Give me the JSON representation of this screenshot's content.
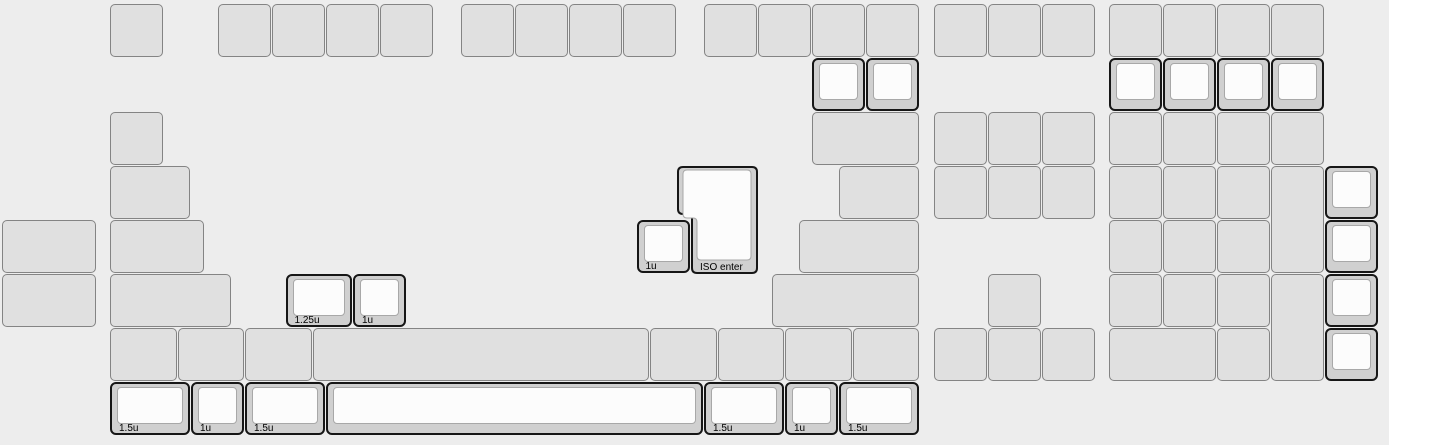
{
  "canvas": {
    "width_px": 1389,
    "height_px": 445,
    "background_color": "#ededed",
    "page_background": "#ffffff"
  },
  "key_style": {
    "unit_px": 54,
    "origin_x_px": 2,
    "origin_y_px": 4,
    "plain_fill": "#e0e0e0",
    "plain_border": "#848484",
    "selected_outer_fill": "#d0d0d0",
    "selected_outline": "#161616",
    "selected_top_fill": "#fcfcfc",
    "selected_top_border": "#a8a8a8",
    "label_color": "#000000"
  },
  "keys": [
    [
      2,
      0,
      1,
      1,
      0,
      ""
    ],
    [
      4,
      0,
      1,
      1,
      0,
      ""
    ],
    [
      5,
      0,
      1,
      1,
      0,
      ""
    ],
    [
      6,
      0,
      1,
      1,
      0,
      ""
    ],
    [
      7,
      0,
      1,
      1,
      0,
      ""
    ],
    [
      8.5,
      0,
      1,
      1,
      0,
      ""
    ],
    [
      9.5,
      0,
      1,
      1,
      0,
      ""
    ],
    [
      10.5,
      0,
      1,
      1,
      0,
      ""
    ],
    [
      11.5,
      0,
      1,
      1,
      0,
      ""
    ],
    [
      13,
      0,
      1,
      1,
      0,
      ""
    ],
    [
      14,
      0,
      1,
      1,
      0,
      ""
    ],
    [
      15,
      0,
      1,
      1,
      0,
      ""
    ],
    [
      16,
      0,
      1,
      1,
      0,
      ""
    ],
    [
      17.25,
      0,
      1,
      1,
      0,
      ""
    ],
    [
      18.25,
      0,
      1,
      1,
      0,
      ""
    ],
    [
      19.25,
      0,
      1,
      1,
      0,
      ""
    ],
    [
      20.5,
      0,
      1,
      1,
      0,
      ""
    ],
    [
      21.5,
      0,
      1,
      1,
      0,
      ""
    ],
    [
      22.5,
      0,
      1,
      1,
      0,
      ""
    ],
    [
      23.5,
      0,
      1,
      1,
      0,
      ""
    ],
    [
      15,
      1,
      1,
      1,
      1,
      ""
    ],
    [
      16,
      1,
      1,
      1,
      1,
      ""
    ],
    [
      20.5,
      1,
      1,
      1,
      1,
      ""
    ],
    [
      21.5,
      1,
      1,
      1,
      1,
      ""
    ],
    [
      22.5,
      1,
      1,
      1,
      1,
      ""
    ],
    [
      23.5,
      1,
      1,
      1,
      1,
      ""
    ],
    [
      2,
      2,
      1,
      1,
      0,
      ""
    ],
    [
      15,
      2,
      2,
      1,
      0,
      ""
    ],
    [
      17.25,
      2,
      1,
      1,
      0,
      ""
    ],
    [
      18.25,
      2,
      1,
      1,
      0,
      ""
    ],
    [
      19.25,
      2,
      1,
      1,
      0,
      ""
    ],
    [
      20.5,
      2,
      1,
      1,
      0,
      ""
    ],
    [
      21.5,
      2,
      1,
      1,
      0,
      ""
    ],
    [
      22.5,
      2,
      1,
      1,
      0,
      ""
    ],
    [
      23.5,
      2,
      1,
      1,
      0,
      ""
    ],
    [
      2,
      3,
      1.5,
      1,
      0,
      ""
    ],
    [
      15.5,
      3,
      1.5,
      1,
      0,
      ""
    ],
    [
      17.25,
      3,
      1,
      1,
      0,
      ""
    ],
    [
      18.25,
      3,
      1,
      1,
      0,
      ""
    ],
    [
      19.25,
      3,
      1,
      1,
      0,
      ""
    ],
    [
      20.5,
      3,
      1,
      1,
      0,
      ""
    ],
    [
      21.5,
      3,
      1,
      1,
      0,
      ""
    ],
    [
      22.5,
      3,
      1,
      1,
      0,
      ""
    ],
    [
      23.5,
      3,
      1,
      2,
      0,
      ""
    ],
    [
      24.5,
      3,
      1,
      1,
      1,
      ""
    ],
    [
      0,
      4,
      1.75,
      1,
      0,
      ""
    ],
    [
      2,
      4,
      1.75,
      1,
      0,
      ""
    ],
    [
      11.75,
      4,
      1,
      1,
      1,
      "1u"
    ],
    [
      14.75,
      4,
      2.25,
      1,
      0,
      ""
    ],
    [
      20.5,
      4,
      1,
      1,
      0,
      ""
    ],
    [
      21.5,
      4,
      1,
      1,
      0,
      ""
    ],
    [
      22.5,
      4,
      1,
      1,
      0,
      ""
    ],
    [
      24.5,
      4,
      1,
      1,
      1,
      ""
    ],
    [
      0,
      5,
      1.75,
      1,
      0,
      ""
    ],
    [
      2,
      5,
      2.25,
      1,
      0,
      ""
    ],
    [
      5.25,
      5,
      1.25,
      1,
      1,
      "1.25u"
    ],
    [
      6.5,
      5,
      1,
      1,
      1,
      "1u"
    ],
    [
      14.25,
      5,
      2.75,
      1,
      0,
      ""
    ],
    [
      18.25,
      5,
      1,
      1,
      0,
      ""
    ],
    [
      20.5,
      5,
      1,
      1,
      0,
      ""
    ],
    [
      21.5,
      5,
      1,
      1,
      0,
      ""
    ],
    [
      22.5,
      5,
      1,
      1,
      0,
      ""
    ],
    [
      23.5,
      5,
      1,
      2,
      0,
      ""
    ],
    [
      24.5,
      5,
      1,
      1,
      1,
      ""
    ],
    [
      2,
      6,
      1.25,
      1,
      0,
      ""
    ],
    [
      3.25,
      6,
      1.25,
      1,
      0,
      ""
    ],
    [
      4.5,
      6,
      1.25,
      1,
      0,
      ""
    ],
    [
      5.75,
      6,
      6.25,
      1,
      0,
      ""
    ],
    [
      12,
      6,
      1.25,
      1,
      0,
      ""
    ],
    [
      13.25,
      6,
      1.25,
      1,
      0,
      ""
    ],
    [
      14.5,
      6,
      1.25,
      1,
      0,
      ""
    ],
    [
      15.75,
      6,
      1.25,
      1,
      0,
      ""
    ],
    [
      17.25,
      6,
      1,
      1,
      0,
      ""
    ],
    [
      18.25,
      6,
      1,
      1,
      0,
      ""
    ],
    [
      19.25,
      6,
      1,
      1,
      0,
      ""
    ],
    [
      20.5,
      6,
      2,
      1,
      0,
      ""
    ],
    [
      22.5,
      6,
      1,
      1,
      0,
      ""
    ],
    [
      24.5,
      6,
      1,
      1,
      1,
      ""
    ],
    [
      2,
      7,
      1.5,
      1,
      1,
      "1.5u"
    ],
    [
      3.5,
      7,
      1,
      1,
      1,
      "1u"
    ],
    [
      4.5,
      7,
      1.5,
      1,
      1,
      "1.5u"
    ],
    [
      6,
      7,
      7,
      1,
      1,
      ""
    ],
    [
      13,
      7,
      1.5,
      1,
      1,
      "1.5u"
    ],
    [
      14.5,
      7,
      1,
      1,
      1,
      "1u"
    ],
    [
      15.5,
      7,
      1.5,
      1,
      1,
      "1.5u"
    ]
  ],
  "iso_enter": {
    "x": 12.5,
    "y": 3,
    "w": 1.5,
    "h": 2,
    "label": "ISO enter"
  }
}
